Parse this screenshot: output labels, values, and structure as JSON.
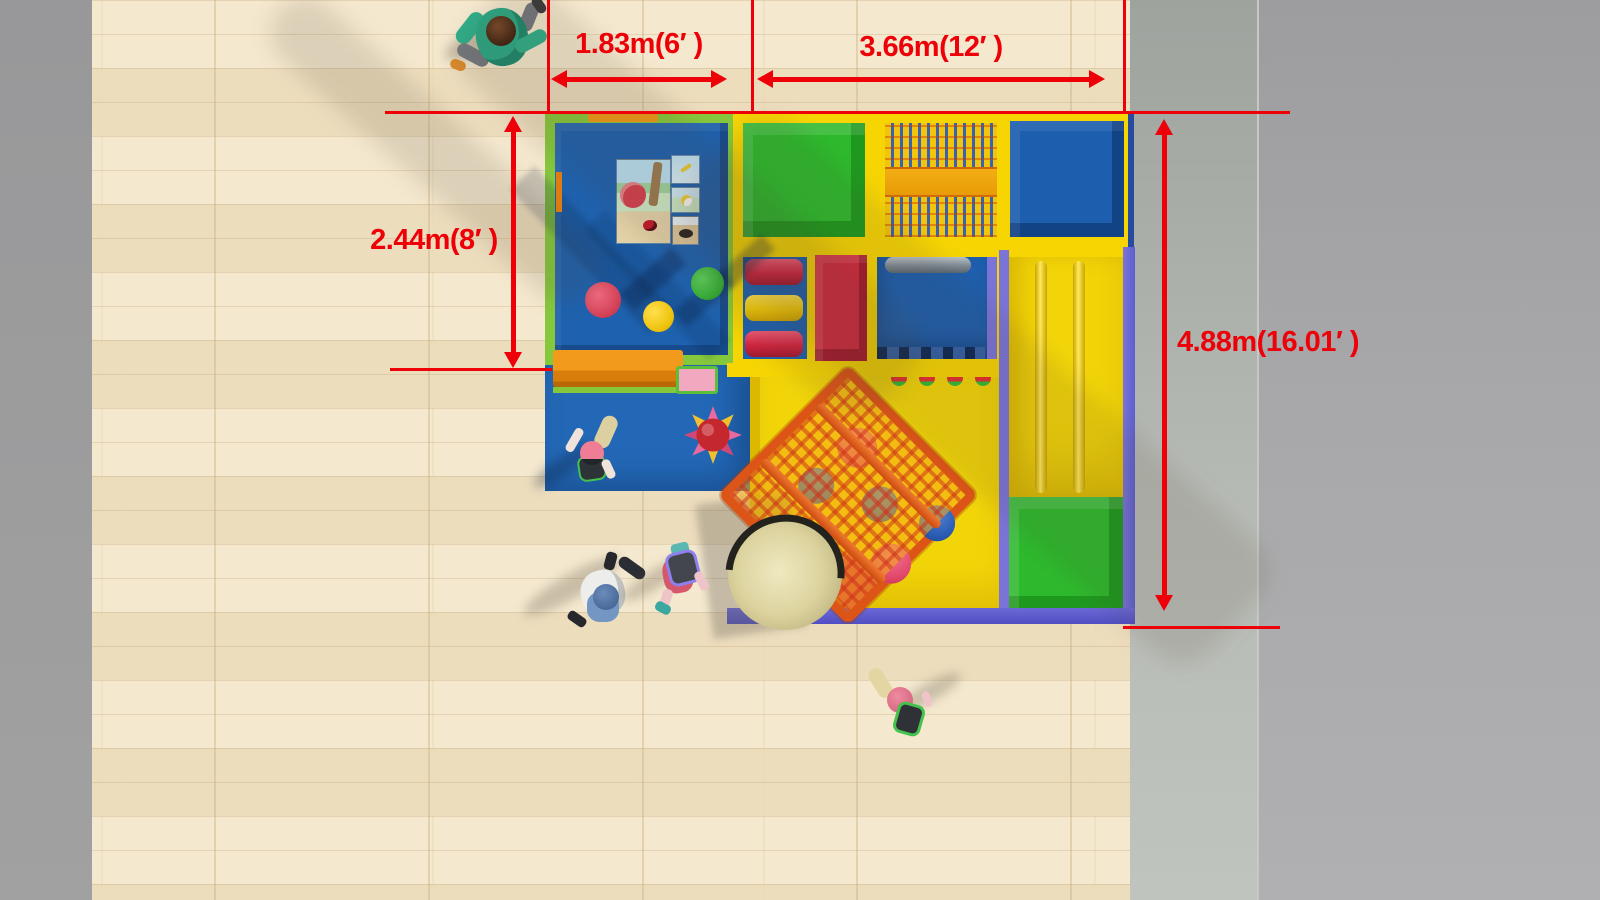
{
  "scene": {
    "description": "Top view rendering of an indoor soft-play playground on a wooden floor with red dimension annotations",
    "floor_color": "#f1e3c6",
    "wall_left_color": "#9b9b9b",
    "wall_right_color": "#aaacae",
    "dimension_color": "#ee0008"
  },
  "dimensions": {
    "horizontal_left": {
      "label": "1.83m(6′ )"
    },
    "horizontal_right": {
      "label": "3.66m(12′ )"
    },
    "vertical_left": {
      "label": "2.44m(8′ )"
    },
    "vertical_right": {
      "label": "4.88m(16.01′ )"
    }
  },
  "palette": {
    "frame_yellow": "#f6d503",
    "frame_green": "#86c83c",
    "floor_blue": "#1e61ae",
    "block_green": "#2db92d",
    "block_red": "#d5293f",
    "purple_border": "#6f6ad6",
    "bench_orange": "#f09a16",
    "net_orange": "#dd5417",
    "dome_beige": "#d6cd96"
  }
}
